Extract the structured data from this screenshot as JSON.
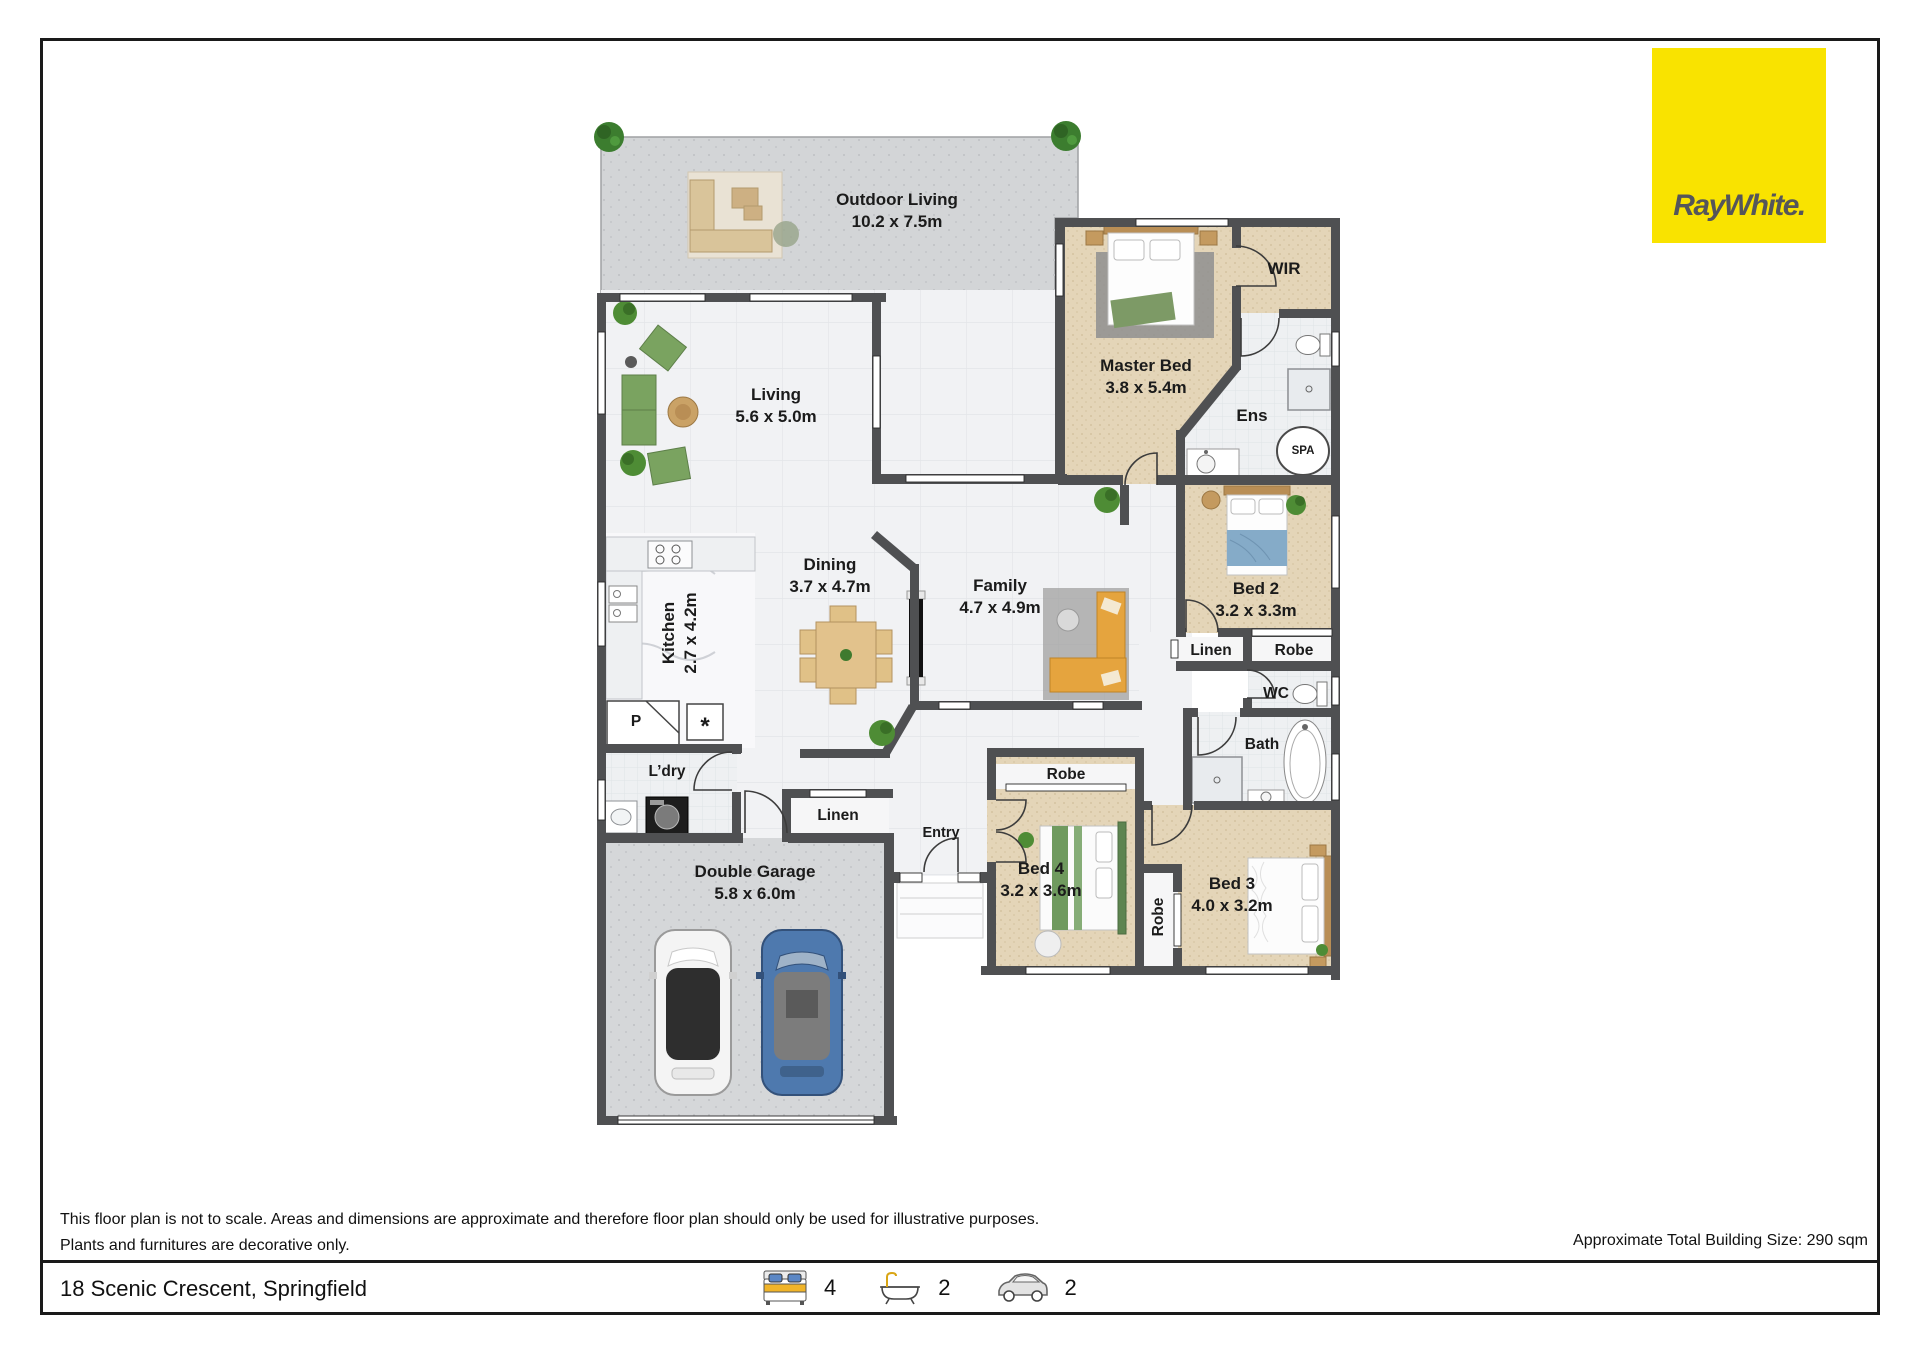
{
  "branding": {
    "logo_text": "RayWhite.",
    "colors": {
      "brand_yellow": "#F9E300",
      "logo_text": "#55565A",
      "wall": "#4F5052",
      "carpet": "#E4D5B8",
      "tile": "#F1F2F4",
      "concrete": "#D3D5D7"
    }
  },
  "rooms": {
    "outdoor_living": {
      "name": "Outdoor Living",
      "dims": "10.2 x 7.5m"
    },
    "living": {
      "name": "Living",
      "dims": "5.6 x 5.0m"
    },
    "master_bed": {
      "name": "Master Bed",
      "dims": "3.8 x 5.4m"
    },
    "wir": {
      "name": "WIR"
    },
    "ens": {
      "name": "Ens"
    },
    "spa": {
      "name": "SPA"
    },
    "bed2": {
      "name": "Bed 2",
      "dims": "3.2 x 3.3m"
    },
    "linen_hall": {
      "name": "Linen"
    },
    "robe_bed2": {
      "name": "Robe"
    },
    "wc": {
      "name": "WC"
    },
    "bath": {
      "name": "Bath"
    },
    "dining": {
      "name": "Dining",
      "dims": "3.7 x 4.7m"
    },
    "family": {
      "name": "Family",
      "dims": "4.7 x 4.9m"
    },
    "kitchen": {
      "name": "Kitchen",
      "dims": "2.7 x 4.2m"
    },
    "pantry": {
      "name": "P"
    },
    "appliance": {
      "name": "*"
    },
    "laundry": {
      "name": "L’dry"
    },
    "linen_entry": {
      "name": "Linen"
    },
    "entry": {
      "name": "Entry"
    },
    "robe_bed4": {
      "name": "Robe"
    },
    "bed4": {
      "name": "Bed 4",
      "dims": "3.2 x 3.6m"
    },
    "robe_bed3": {
      "name": "Robe"
    },
    "bed3": {
      "name": "Bed 3",
      "dims": "4.0 x 3.2m"
    },
    "garage": {
      "name": "Double Garage",
      "dims": "5.8 x 6.0m"
    }
  },
  "footer": {
    "disclaimer_line1": "This floor plan is not to scale. Areas and dimensions are approximate and therefore floor plan should only be used for illustrative purposes.",
    "disclaimer_line2": "Plants and furnitures are decorative only.",
    "building_size": "Approximate Total Building Size: 290 sqm",
    "address": "18 Scenic Crescent, Springfield",
    "stats": {
      "beds": "4",
      "baths": "2",
      "cars": "2"
    }
  }
}
